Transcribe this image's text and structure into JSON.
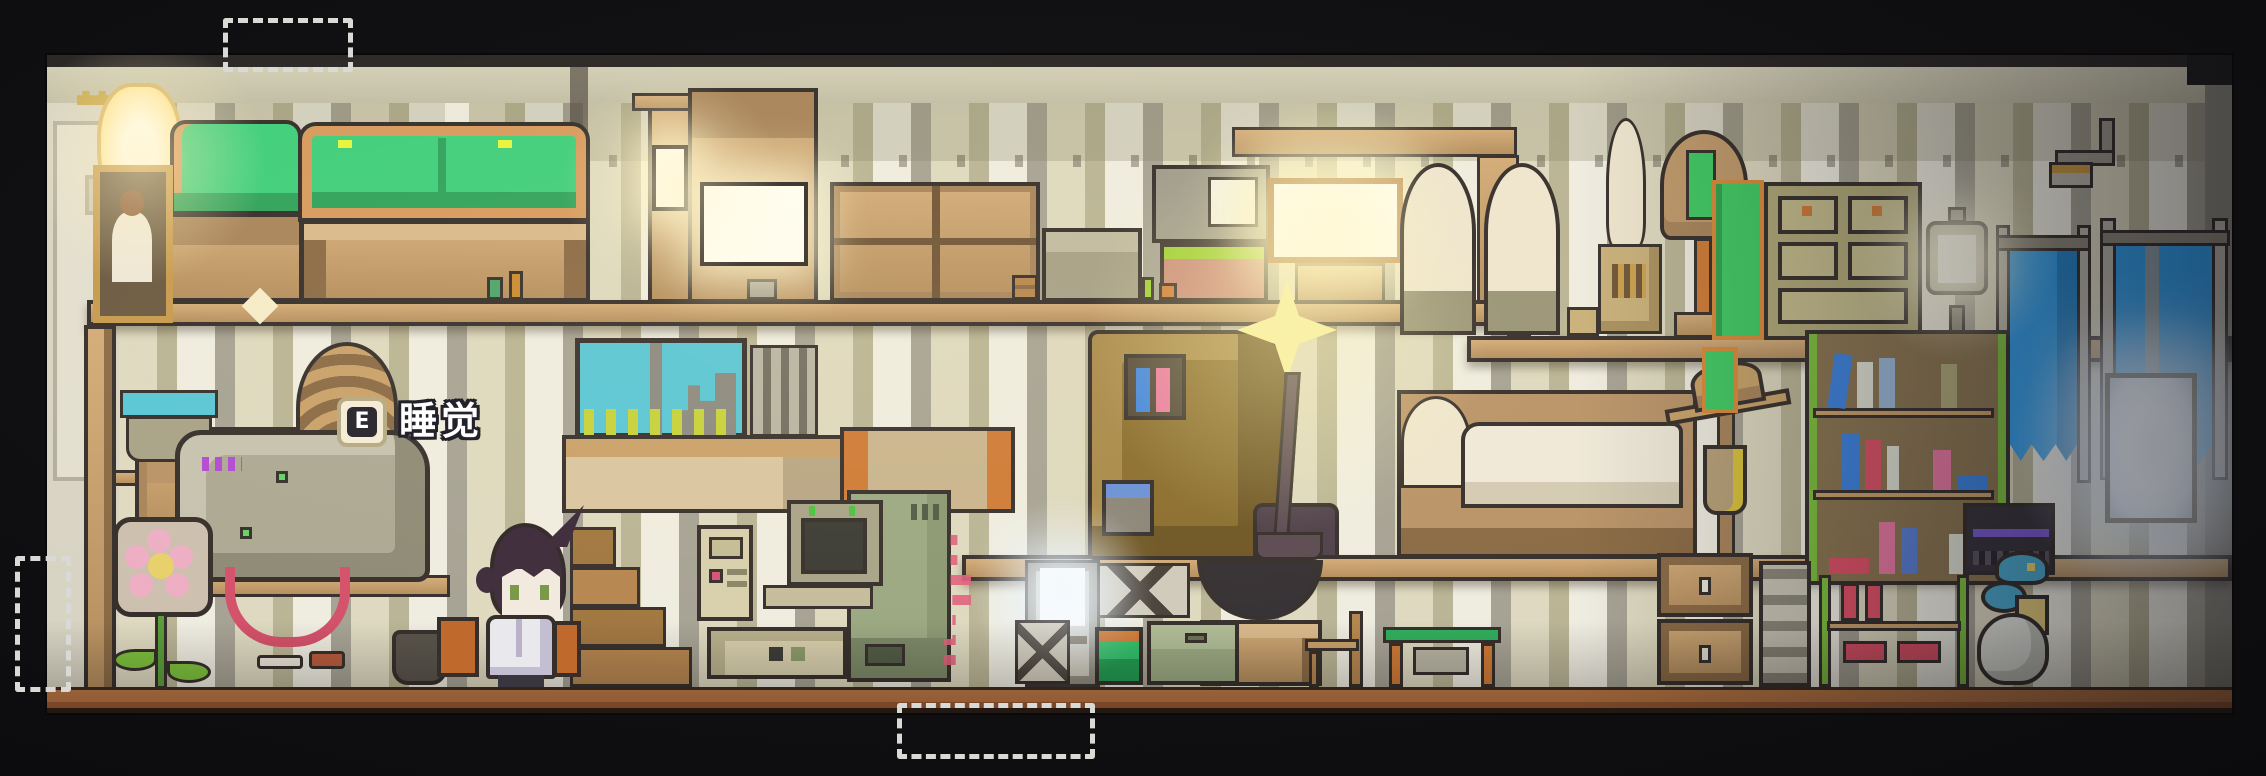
{
  "hud": {
    "interaction_prompt": {
      "key_label": "E",
      "action_label": "睡觉"
    }
  },
  "palette": {
    "background": "#101012",
    "outline": "#352e2b",
    "floor_orange": "#c07a45",
    "wall_cream": "#ded9c0",
    "wall_olive": "#b9b495",
    "wall_white": "#efede1",
    "wall_gray": "#a6a294",
    "wood": "#c19a6b",
    "wood_dark": "#8a6a45",
    "sofa_green": "#3fcf7c",
    "aquarium_cyan": "#57c6d6",
    "banner_blue": "#2f9ce8",
    "wardrobe_green": "#3ecb63",
    "lamp_glow": "#fff8dc",
    "star_yellow": "#f7ef9e",
    "book_blue": "#3b82e0",
    "book_red": "#dd5064",
    "book_pink": "#e878a0",
    "accent_lime": "#9ccf30",
    "accent_orange": "#cf7a35",
    "hair_purple": "#42303f",
    "coat_white": "#e9e8ec",
    "keycap_cream": "#f4ecd4",
    "keycap_dark": "#2e2b33",
    "prompt_text": "#ffffff",
    "slot_dash": "#d9d9d5"
  },
  "scene": {
    "objects": [
      "wall-lamp",
      "portrait-frame",
      "green-armchair",
      "green-sofa",
      "street-lamp",
      "tv-cabinet",
      "wooden-dresser",
      "nightstand",
      "microwave-tv",
      "glowing-monitor",
      "cream-armchairs",
      "goose-lamp",
      "bell-lamp",
      "green-wardrobe",
      "olive-dresser",
      "lantern",
      "shower-pipe",
      "blue-banner-left",
      "blue-banner-right",
      "coat-hook-pole",
      "cyan-bathtub",
      "rolled-mattress",
      "mattress-pile-sleep-spot",
      "red-hammock",
      "flower-clock",
      "aquarium",
      "organ-pipes",
      "handle-cabinet",
      "loom-machine",
      "star-lamp",
      "bed",
      "hat-stand",
      "bookshelf",
      "window-light",
      "dark-television",
      "snowman",
      "staircase",
      "pc-tower",
      "crt-monitor",
      "printer",
      "server-cabinet",
      "floor-lamp",
      "trellis",
      "green-chest",
      "olive-chest",
      "wok-pot",
      "purple-pot",
      "chair",
      "green-top-table",
      "storage-crates",
      "ladder",
      "red-book-shelf",
      "player-character"
    ]
  }
}
